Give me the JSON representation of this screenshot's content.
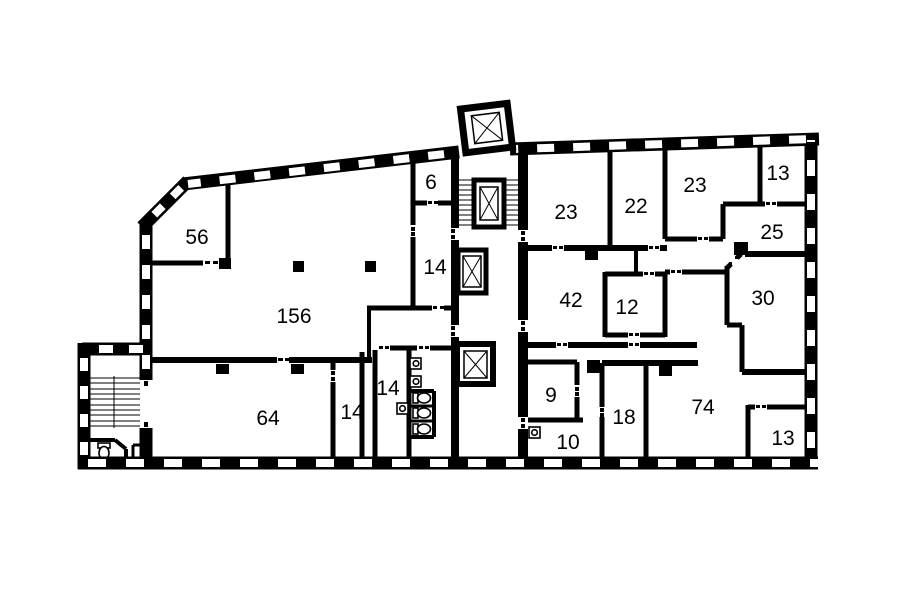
{
  "document": {
    "type": "architectural-floor-plan",
    "background": "#ffffff",
    "wall_color": "#000000"
  },
  "rooms": [
    {
      "id": "room-56",
      "area": "56"
    },
    {
      "id": "room-156",
      "area": "156"
    },
    {
      "id": "room-6",
      "area": "6"
    },
    {
      "id": "room-14-upper",
      "area": "14"
    },
    {
      "id": "room-64",
      "area": "64"
    },
    {
      "id": "room-14-lower",
      "area": "14"
    },
    {
      "id": "room-14-wc-lobby",
      "area": "14"
    },
    {
      "id": "room-9",
      "area": "9"
    },
    {
      "id": "room-10",
      "area": "10"
    },
    {
      "id": "room-42",
      "area": "42"
    },
    {
      "id": "room-12",
      "area": "12"
    },
    {
      "id": "room-18",
      "area": "18"
    },
    {
      "id": "room-74",
      "area": "74"
    },
    {
      "id": "room-23-left",
      "area": "23"
    },
    {
      "id": "room-22",
      "area": "22"
    },
    {
      "id": "room-23-right",
      "area": "23"
    },
    {
      "id": "room-13-top",
      "area": "13"
    },
    {
      "id": "room-25",
      "area": "25"
    },
    {
      "id": "room-30",
      "area": "30"
    },
    {
      "id": "room-13-bottom",
      "area": "13"
    }
  ],
  "icons": {
    "elevator": "x-crossed-rectangle",
    "stairs": "tread-lines",
    "toilet": "wc-bowl-with-tank",
    "sink": "wash-basin-square"
  }
}
